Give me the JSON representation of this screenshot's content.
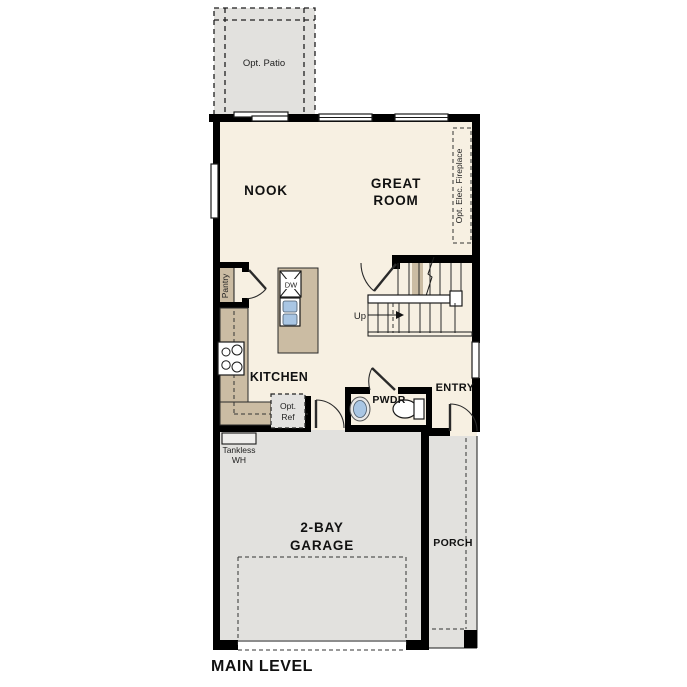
{
  "colors": {
    "floor": "#f7f0e2",
    "hardscape": "#e2e1de",
    "counter": "#cbbca3",
    "wall": "#000000",
    "sink_blue": "#a9c6e4",
    "ref_gray": "#e3e2e0"
  },
  "rooms": {
    "patio": {
      "label": "Opt. Patio"
    },
    "nook": {
      "label": "NOOK"
    },
    "great_room": {
      "line1": "GREAT",
      "line2": "ROOM"
    },
    "kitchen": {
      "label": "KITCHEN"
    },
    "pantry": {
      "label": "Pantry"
    },
    "powder": {
      "label": "PWDR"
    },
    "entry": {
      "label": "ENTRY"
    },
    "garage": {
      "line1": "2-BAY",
      "line2": "GARAGE"
    },
    "porch": {
      "label": "PORCH"
    }
  },
  "annotations": {
    "fireplace": "Opt. Elec. Fireplace",
    "dishwasher": "DW",
    "stairs": "Up",
    "opt_ref": {
      "line1": "Opt.",
      "line2": "Ref"
    },
    "tankless": {
      "line1": "Tankless",
      "line2": "WH"
    }
  },
  "footer": {
    "label": "MAIN LEVEL"
  }
}
